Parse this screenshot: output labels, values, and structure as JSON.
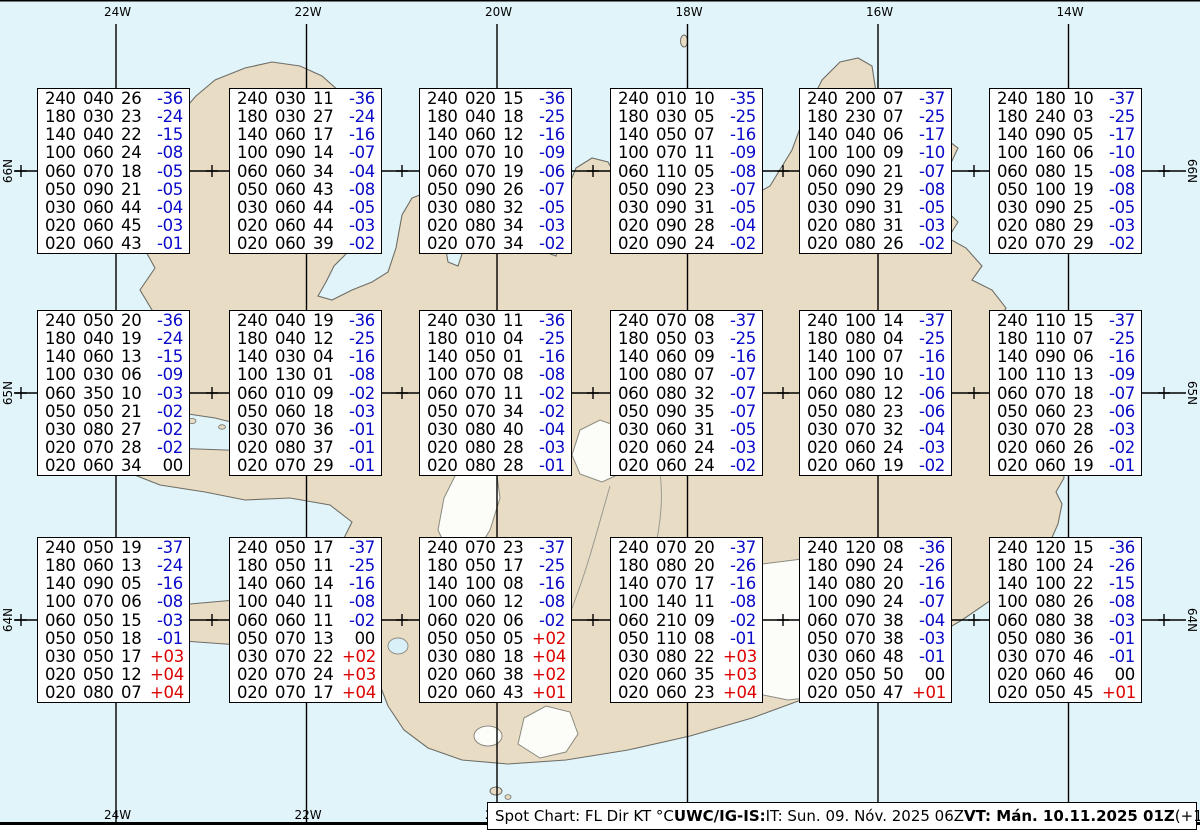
{
  "map": {
    "meridian_labels": [
      "24W",
      "22W",
      "20W",
      "18W",
      "16W",
      "14W"
    ],
    "parallel_labels": [
      "66N",
      "65N",
      "64N"
    ]
  },
  "colors": {
    "ocean": "#e1f4fa",
    "land": "#e9dcc5",
    "glacier": "#fcfcf8",
    "coast": "#6e6e66",
    "graticule": "#000000",
    "temp_negative": "#0a0ac8",
    "temp_positive": "#dd0000",
    "temp_zero": "#000000"
  },
  "caption": {
    "segments": [
      {
        "text": "Spot Chart: FL Dir KT °C ",
        "bold": false
      },
      {
        "text": "UWC/IG-IS:",
        "bold": true
      },
      {
        "text": " IT: Sun. 09. Nóv. 2025 06Z ",
        "bold": false
      },
      {
        "text": "VT: Mán. 10.11.2025 01Z",
        "bold": true
      },
      {
        "text": " (+19 h)",
        "bold": false
      }
    ]
  },
  "spot_boxes": [
    {
      "rows": [
        [
          "240",
          "040",
          "26",
          "-36"
        ],
        [
          "180",
          "030",
          "23",
          "-24"
        ],
        [
          "140",
          "040",
          "22",
          "-15"
        ],
        [
          "100",
          "060",
          "24",
          "-08"
        ],
        [
          "060",
          "070",
          "18",
          "-05"
        ],
        [
          "050",
          "090",
          "21",
          "-05"
        ],
        [
          "030",
          "060",
          "44",
          "-04"
        ],
        [
          "020",
          "060",
          "45",
          "-03"
        ],
        [
          "020",
          "060",
          "43",
          "-01"
        ]
      ]
    },
    {
      "rows": [
        [
          "240",
          "030",
          "11",
          "-36"
        ],
        [
          "180",
          "030",
          "27",
          "-24"
        ],
        [
          "140",
          "060",
          "17",
          "-16"
        ],
        [
          "100",
          "090",
          "14",
          "-07"
        ],
        [
          "060",
          "060",
          "34",
          "-04"
        ],
        [
          "050",
          "060",
          "43",
          "-08"
        ],
        [
          "030",
          "060",
          "44",
          "-05"
        ],
        [
          "020",
          "060",
          "44",
          "-03"
        ],
        [
          "020",
          "060",
          "39",
          "-02"
        ]
      ]
    },
    {
      "rows": [
        [
          "240",
          "020",
          "15",
          "-36"
        ],
        [
          "180",
          "040",
          "18",
          "-25"
        ],
        [
          "140",
          "060",
          "12",
          "-16"
        ],
        [
          "100",
          "070",
          "10",
          "-09"
        ],
        [
          "060",
          "070",
          "19",
          "-06"
        ],
        [
          "050",
          "090",
          "26",
          "-07"
        ],
        [
          "030",
          "080",
          "32",
          "-05"
        ],
        [
          "020",
          "080",
          "34",
          "-03"
        ],
        [
          "020",
          "070",
          "34",
          "-02"
        ]
      ]
    },
    {
      "rows": [
        [
          "240",
          "010",
          "10",
          "-35"
        ],
        [
          "180",
          "030",
          "05",
          "-25"
        ],
        [
          "140",
          "050",
          "07",
          "-16"
        ],
        [
          "100",
          "070",
          "11",
          "-09"
        ],
        [
          "060",
          "110",
          "05",
          "-08"
        ],
        [
          "050",
          "090",
          "23",
          "-07"
        ],
        [
          "030",
          "090",
          "31",
          "-05"
        ],
        [
          "020",
          "090",
          "28",
          "-04"
        ],
        [
          "020",
          "090",
          "24",
          "-02"
        ]
      ]
    },
    {
      "rows": [
        [
          "240",
          "200",
          "07",
          "-37"
        ],
        [
          "180",
          "230",
          "07",
          "-25"
        ],
        [
          "140",
          "040",
          "06",
          "-17"
        ],
        [
          "100",
          "100",
          "09",
          "-10"
        ],
        [
          "060",
          "090",
          "21",
          "-07"
        ],
        [
          "050",
          "090",
          "29",
          "-08"
        ],
        [
          "030",
          "090",
          "31",
          "-05"
        ],
        [
          "020",
          "080",
          "31",
          "-03"
        ],
        [
          "020",
          "080",
          "26",
          "-02"
        ]
      ]
    },
    {
      "rows": [
        [
          "240",
          "180",
          "10",
          "-37"
        ],
        [
          "180",
          "240",
          "03",
          "-25"
        ],
        [
          "140",
          "090",
          "05",
          "-17"
        ],
        [
          "100",
          "160",
          "06",
          "-10"
        ],
        [
          "060",
          "080",
          "15",
          "-08"
        ],
        [
          "050",
          "100",
          "19",
          "-08"
        ],
        [
          "030",
          "090",
          "25",
          "-05"
        ],
        [
          "020",
          "080",
          "29",
          "-03"
        ],
        [
          "020",
          "070",
          "29",
          "-02"
        ]
      ]
    },
    {
      "rows": [
        [
          "240",
          "050",
          "20",
          "-36"
        ],
        [
          "180",
          "040",
          "19",
          "-24"
        ],
        [
          "140",
          "060",
          "13",
          "-15"
        ],
        [
          "100",
          "030",
          "06",
          "-09"
        ],
        [
          "060",
          "350",
          "10",
          "-03"
        ],
        [
          "050",
          "050",
          "21",
          "-02"
        ],
        [
          "030",
          "080",
          "27",
          "-02"
        ],
        [
          "020",
          "070",
          "28",
          "-02"
        ],
        [
          "020",
          "060",
          "34",
          "00"
        ]
      ]
    },
    {
      "rows": [
        [
          "240",
          "040",
          "19",
          "-36"
        ],
        [
          "180",
          "040",
          "12",
          "-25"
        ],
        [
          "140",
          "030",
          "04",
          "-16"
        ],
        [
          "100",
          "130",
          "01",
          "-08"
        ],
        [
          "060",
          "010",
          "09",
          "-02"
        ],
        [
          "050",
          "060",
          "18",
          "-03"
        ],
        [
          "030",
          "070",
          "36",
          "-01"
        ],
        [
          "020",
          "080",
          "37",
          "-01"
        ],
        [
          "020",
          "070",
          "29",
          "-01"
        ]
      ]
    },
    {
      "rows": [
        [
          "240",
          "030",
          "11",
          "-36"
        ],
        [
          "180",
          "010",
          "04",
          "-25"
        ],
        [
          "140",
          "050",
          "01",
          "-16"
        ],
        [
          "100",
          "070",
          "08",
          "-08"
        ],
        [
          "060",
          "070",
          "11",
          "-02"
        ],
        [
          "050",
          "070",
          "34",
          "-02"
        ],
        [
          "030",
          "080",
          "40",
          "-04"
        ],
        [
          "020",
          "080",
          "28",
          "-03"
        ],
        [
          "020",
          "080",
          "28",
          "-01"
        ]
      ]
    },
    {
      "rows": [
        [
          "240",
          "070",
          "08",
          "-37"
        ],
        [
          "180",
          "050",
          "03",
          "-25"
        ],
        [
          "140",
          "060",
          "09",
          "-16"
        ],
        [
          "100",
          "080",
          "07",
          "-07"
        ],
        [
          "060",
          "080",
          "32",
          "-07"
        ],
        [
          "050",
          "090",
          "35",
          "-07"
        ],
        [
          "030",
          "060",
          "31",
          "-05"
        ],
        [
          "020",
          "060",
          "24",
          "-03"
        ],
        [
          "020",
          "060",
          "24",
          "-02"
        ]
      ]
    },
    {
      "rows": [
        [
          "240",
          "100",
          "14",
          "-37"
        ],
        [
          "180",
          "080",
          "04",
          "-25"
        ],
        [
          "140",
          "100",
          "07",
          "-16"
        ],
        [
          "100",
          "090",
          "10",
          "-10"
        ],
        [
          "060",
          "080",
          "12",
          "-06"
        ],
        [
          "050",
          "080",
          "23",
          "-06"
        ],
        [
          "030",
          "070",
          "32",
          "-04"
        ],
        [
          "020",
          "060",
          "24",
          "-03"
        ],
        [
          "020",
          "060",
          "19",
          "-02"
        ]
      ]
    },
    {
      "rows": [
        [
          "240",
          "110",
          "15",
          "-37"
        ],
        [
          "180",
          "110",
          "07",
          "-25"
        ],
        [
          "140",
          "090",
          "06",
          "-16"
        ],
        [
          "100",
          "110",
          "13",
          "-09"
        ],
        [
          "060",
          "070",
          "18",
          "-07"
        ],
        [
          "050",
          "060",
          "23",
          "-06"
        ],
        [
          "030",
          "070",
          "28",
          "-03"
        ],
        [
          "020",
          "060",
          "26",
          "-02"
        ],
        [
          "020",
          "060",
          "19",
          "-01"
        ]
      ]
    },
    {
      "rows": [
        [
          "240",
          "050",
          "19",
          "-37"
        ],
        [
          "180",
          "060",
          "13",
          "-24"
        ],
        [
          "140",
          "090",
          "05",
          "-16"
        ],
        [
          "100",
          "070",
          "06",
          "-08"
        ],
        [
          "060",
          "050",
          "15",
          "-03"
        ],
        [
          "050",
          "050",
          "18",
          "-01"
        ],
        [
          "030",
          "050",
          "17",
          "+03"
        ],
        [
          "020",
          "050",
          "12",
          "+04"
        ],
        [
          "020",
          "080",
          "07",
          "+04"
        ]
      ]
    },
    {
      "rows": [
        [
          "240",
          "050",
          "17",
          "-37"
        ],
        [
          "180",
          "050",
          "11",
          "-25"
        ],
        [
          "140",
          "060",
          "14",
          "-16"
        ],
        [
          "100",
          "040",
          "11",
          "-08"
        ],
        [
          "060",
          "060",
          "11",
          "-02"
        ],
        [
          "050",
          "070",
          "13",
          "00"
        ],
        [
          "030",
          "070",
          "22",
          "+02"
        ],
        [
          "020",
          "070",
          "24",
          "+03"
        ],
        [
          "020",
          "070",
          "17",
          "+04"
        ]
      ]
    },
    {
      "rows": [
        [
          "240",
          "070",
          "23",
          "-37"
        ],
        [
          "180",
          "050",
          "17",
          "-25"
        ],
        [
          "140",
          "100",
          "08",
          "-16"
        ],
        [
          "100",
          "060",
          "12",
          "-08"
        ],
        [
          "060",
          "020",
          "06",
          "-02"
        ],
        [
          "050",
          "050",
          "05",
          "+02"
        ],
        [
          "030",
          "080",
          "18",
          "+04"
        ],
        [
          "020",
          "060",
          "38",
          "+02"
        ],
        [
          "020",
          "060",
          "43",
          "+01"
        ]
      ]
    },
    {
      "rows": [
        [
          "240",
          "070",
          "20",
          "-37"
        ],
        [
          "180",
          "080",
          "20",
          "-26"
        ],
        [
          "140",
          "070",
          "17",
          "-16"
        ],
        [
          "100",
          "140",
          "11",
          "-08"
        ],
        [
          "060",
          "210",
          "09",
          "-02"
        ],
        [
          "050",
          "110",
          "08",
          "-01"
        ],
        [
          "030",
          "080",
          "22",
          "+03"
        ],
        [
          "020",
          "060",
          "35",
          "+03"
        ],
        [
          "020",
          "060",
          "23",
          "+04"
        ]
      ]
    },
    {
      "rows": [
        [
          "240",
          "120",
          "08",
          "-36"
        ],
        [
          "180",
          "090",
          "24",
          "-26"
        ],
        [
          "140",
          "080",
          "20",
          "-16"
        ],
        [
          "100",
          "090",
          "24",
          "-07"
        ],
        [
          "060",
          "070",
          "38",
          "-04"
        ],
        [
          "050",
          "070",
          "38",
          "-03"
        ],
        [
          "030",
          "060",
          "48",
          "-01"
        ],
        [
          "020",
          "050",
          "50",
          "00"
        ],
        [
          "020",
          "050",
          "47",
          "+01"
        ]
      ]
    },
    {
      "rows": [
        [
          "240",
          "120",
          "15",
          "-36"
        ],
        [
          "180",
          "100",
          "24",
          "-26"
        ],
        [
          "140",
          "100",
          "22",
          "-15"
        ],
        [
          "100",
          "080",
          "26",
          "-08"
        ],
        [
          "060",
          "080",
          "38",
          "-03"
        ],
        [
          "050",
          "080",
          "36",
          "-01"
        ],
        [
          "030",
          "070",
          "46",
          "-01"
        ],
        [
          "020",
          "060",
          "46",
          "00"
        ],
        [
          "020",
          "050",
          "45",
          "+01"
        ]
      ]
    }
  ]
}
